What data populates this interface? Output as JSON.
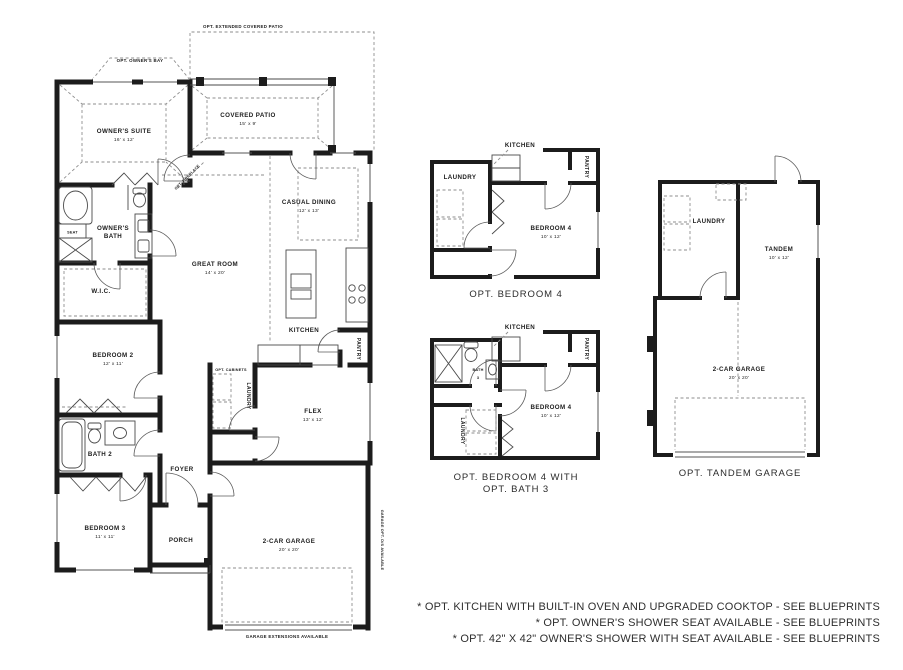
{
  "colors": {
    "wall": "#1c1c1c",
    "dash": "#8e8e8e",
    "text": "#1c1c1c"
  },
  "main_plan": {
    "annotations": {
      "extended_patio": "OPT. EXTENDED COVERED PATIO",
      "owners_bay": "OPT. OWNER'S BAY",
      "fireplace": "OPT. FIREPLACE",
      "cabinets": "OPT. CABINETS",
      "seat": "SEAT",
      "garage_extensions": "GARAGE EXTENSIONS AVAILABLE",
      "garage_side_note": "GARAGE OPT. D/S AVAILABLE"
    },
    "rooms": {
      "owners_suite": {
        "label": "OWNER'S SUITE",
        "dims": "16' x 12'"
      },
      "covered_patio": {
        "label": "COVERED PATIO",
        "dims": "15' x 9'"
      },
      "owners_bath": {
        "line1": "OWNER'S",
        "line2": "BATH"
      },
      "wic": {
        "label": "W.I.C."
      },
      "great_room": {
        "label": "GREAT ROOM",
        "dims": "14' x 20'"
      },
      "casual_dining": {
        "label": "CASUAL DINING",
        "dims": "12' x 13'"
      },
      "kitchen": {
        "label": "KITCHEN"
      },
      "pantry": {
        "label": "PANTRY"
      },
      "laundry": {
        "label": "LAUNDRY"
      },
      "flex": {
        "label": "FLEX",
        "dims": "13' x 12'"
      },
      "bedroom2": {
        "label": "BEDROOM 2",
        "dims": "12' x 11'"
      },
      "bath2": {
        "label": "BATH 2"
      },
      "foyer": {
        "label": "FOYER"
      },
      "bedroom3": {
        "label": "BEDROOM 3",
        "dims": "11' x 11'"
      },
      "porch": {
        "label": "PORCH"
      },
      "garage": {
        "label": "2-CAR GARAGE",
        "dims": "20' x 20'"
      }
    }
  },
  "opt_bedroom4": {
    "caption": "OPT. BEDROOM 4",
    "rooms": {
      "kitchen": "KITCHEN",
      "laundry": "LAUNDRY",
      "pantry": "PANTRY",
      "bedroom4": "BEDROOM 4",
      "bedroom4_dims": "10' x 12'"
    }
  },
  "opt_bedroom4_bath3": {
    "caption_line1": "OPT. BEDROOM 4 WITH",
    "caption_line2": "OPT. BATH 3",
    "rooms": {
      "kitchen": "KITCHEN",
      "bath3_line1": "BATH",
      "bath3_line2": "3",
      "laundry": "LAUNDRY",
      "pantry": "PANTRY",
      "bedroom4": "BEDROOM 4",
      "bedroom4_dims": "10' x 12'"
    }
  },
  "opt_tandem": {
    "caption": "OPT. TANDEM GARAGE",
    "rooms": {
      "laundry": "LAUNDRY",
      "tandem": "TANDEM",
      "tandem_dims": "10' x 12'",
      "garage": "2-CAR GARAGE",
      "garage_dims": "20' x 20'"
    }
  },
  "footnotes": [
    "* OPT. KITCHEN WITH BUILT-IN OVEN AND UPGRADED COOKTOP - SEE BLUEPRINTS",
    "* OPT. OWNER'S SHOWER SEAT AVAILABLE - SEE BLUEPRINTS",
    "* OPT. 42\" X 42\" OWNER'S SHOWER WITH SEAT AVAILABLE - SEE BLUEPRINTS"
  ]
}
